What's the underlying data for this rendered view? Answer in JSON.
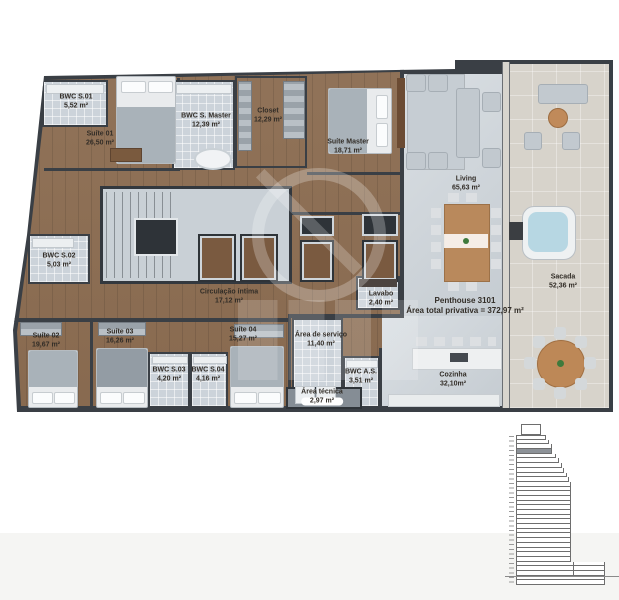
{
  "unit": {
    "name": "Penthouse 3101",
    "area_note": "Área total privativa = 372,97 m²"
  },
  "plan": {
    "rooms": [
      {
        "id": "bwc-s01",
        "label": "BWC S.01",
        "area": "5,52 m²"
      },
      {
        "id": "suite-01",
        "label": "Suíte 01",
        "area": "26,50 m²"
      },
      {
        "id": "bwc-s-master",
        "label": "BWC S. Master",
        "area": "12,39 m²"
      },
      {
        "id": "closet",
        "label": "Closet",
        "area": "12,29 m²"
      },
      {
        "id": "suite-master",
        "label": "Suíte Master",
        "area": "18,71 m²"
      },
      {
        "id": "living",
        "label": "Living",
        "area": "65,63 m²"
      },
      {
        "id": "bwc-s02",
        "label": "BWC S.02",
        "area": "5,03 m²"
      },
      {
        "id": "sacada",
        "label": "Sacada",
        "area": "52,36 m²"
      },
      {
        "id": "circulacao-intima",
        "label": "Circulação íntima",
        "area": "17,12 m²"
      },
      {
        "id": "lavabo",
        "label": "Lavabo",
        "area": "2,40 m²"
      },
      {
        "id": "suite-02",
        "label": "Suíte 02",
        "area": "19,67 m²"
      },
      {
        "id": "suite-03",
        "label": "Suíte 03",
        "area": "16,26 m²"
      },
      {
        "id": "suite-04",
        "label": "Suíte 04",
        "area": "15,27 m²"
      },
      {
        "id": "bwc-s03",
        "label": "BWC S.03",
        "area": "4,20 m²"
      },
      {
        "id": "bwc-s04",
        "label": "BWC S.04",
        "area": "4,16 m²"
      },
      {
        "id": "area-servico",
        "label": "Área de serviço",
        "area": "11,40 m²"
      },
      {
        "id": "bwc-as",
        "label": "BWC A.S.",
        "area": "3,51 m²"
      },
      {
        "id": "cozinha",
        "label": "Cozinha",
        "area": "32,10m²"
      },
      {
        "id": "area-tecnica",
        "label": "Área técnica",
        "area": "2,97 m²"
      }
    ],
    "colors": {
      "wall": "#3a3f45",
      "wood": "#8a6a4e",
      "bath_tile": "#ccd3da",
      "living_floor": "#cdd4da",
      "balcony_floor": "#d7d3cb",
      "hot_tub_water": "#b7d7e3",
      "highlight_floor": "#8d9298"
    }
  },
  "elevation": {
    "description": "building-section-key-plan, highlighted floor = penthouse level",
    "rows": [
      {
        "w": 30
      },
      {
        "w": 33
      },
      {
        "w": 36
      },
      {
        "w": 36,
        "hl": true
      },
      {
        "w": 40
      },
      {
        "w": 43
      },
      {
        "w": 46
      },
      {
        "w": 48
      },
      {
        "w": 51
      },
      {
        "w": 53
      },
      {
        "w": 55
      },
      {
        "w": 55
      },
      {
        "w": 55
      },
      {
        "w": 55
      },
      {
        "w": 55
      },
      {
        "w": 55
      },
      {
        "w": 55
      },
      {
        "w": 55
      },
      {
        "w": 55
      },
      {
        "w": 55
      },
      {
        "w": 55
      },
      {
        "w": 55
      },
      {
        "w": 55
      },
      {
        "w": 55
      },
      {
        "w": 55
      },
      {
        "w": 55
      },
      {
        "w": 55
      },
      {
        "w": 89
      },
      {
        "w": 89
      },
      {
        "w": 89
      },
      {
        "w": 89
      },
      {
        "w": 89
      }
    ]
  },
  "watermark": {
    "present": true
  }
}
